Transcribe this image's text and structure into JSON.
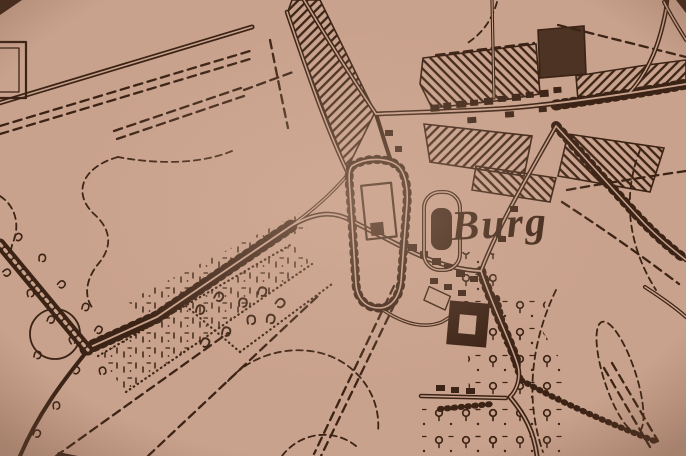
{
  "map": {
    "place_label": "Burg",
    "colors": {
      "paper": "#c9a28d",
      "ink": "#3b2315"
    },
    "layers": [
      "contour-lines",
      "field-paths",
      "roads",
      "tree-lined-avenue",
      "village-built-blocks",
      "castle-enclosure",
      "meadow-strips",
      "orchards",
      "tree-symbols",
      "hedgerows",
      "place-label"
    ]
  }
}
